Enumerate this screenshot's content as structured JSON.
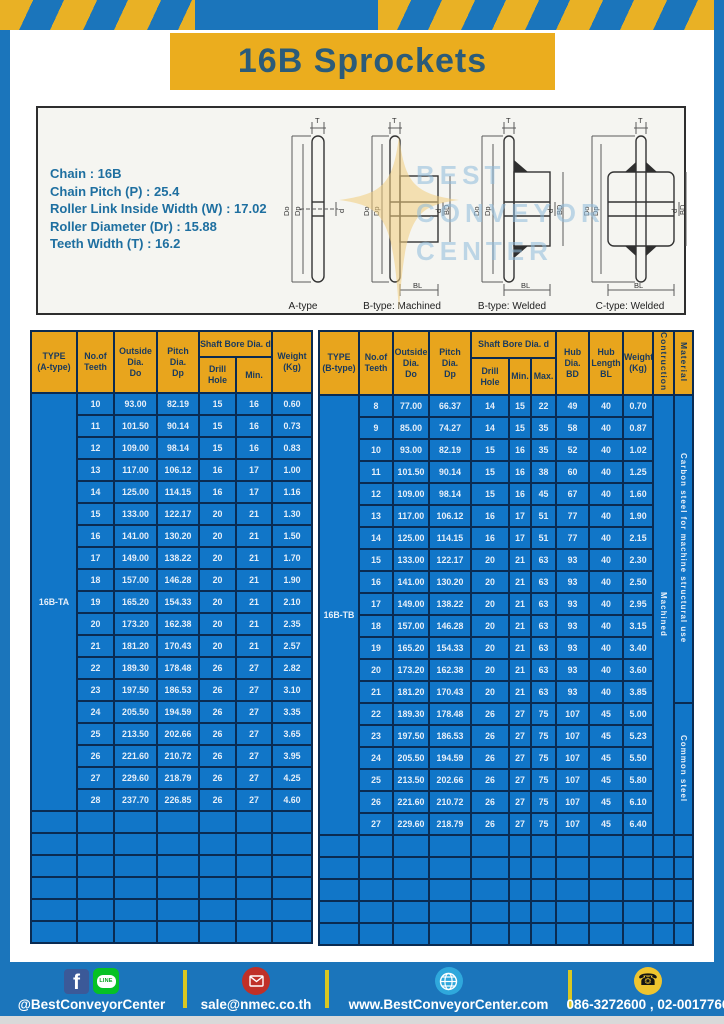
{
  "page": {
    "title": "16B Sprockets"
  },
  "specs": {
    "lines": [
      "Chain  :  16B",
      "Chain Pitch (P)  :  25.4",
      "Roller Link Inside Width (W)  :  17.02",
      "Roller Diameter (Dr)  : 15.88",
      "Teeth Width (T)  :  16.2"
    ]
  },
  "watermark": {
    "lines": [
      "BEST",
      "CONVEYOR",
      "CENTER"
    ]
  },
  "drawings": {
    "captions": [
      "A-type",
      "B-type: Machined",
      "B-type: Welded",
      "C-type: Welded"
    ],
    "dims": {
      "t": "T",
      "do": "Do",
      "dp": "Dp",
      "d": "d",
      "bd": "BD",
      "bl": "BL"
    }
  },
  "tables": {
    "a": {
      "type_label": "16B-TA",
      "headers": {
        "type": "TYPE\n(A-type)",
        "teeth": "No.of\nTeeth",
        "outside": "Outside\nDia.\nDo",
        "pitch": "Pitch Dia.\nDp",
        "shaft_bore": "Shaft Bore Dia. d",
        "drill": "Drill Hole",
        "min": "Min.",
        "weight": "Weight\n(Kg)"
      },
      "rows": [
        [
          "10",
          "93.00",
          "82.19",
          "15",
          "16",
          "0.60"
        ],
        [
          "11",
          "101.50",
          "90.14",
          "15",
          "16",
          "0.73"
        ],
        [
          "12",
          "109.00",
          "98.14",
          "15",
          "16",
          "0.83"
        ],
        [
          "13",
          "117.00",
          "106.12",
          "16",
          "17",
          "1.00"
        ],
        [
          "14",
          "125.00",
          "114.15",
          "16",
          "17",
          "1.16"
        ],
        [
          "15",
          "133.00",
          "122.17",
          "20",
          "21",
          "1.30"
        ],
        [
          "16",
          "141.00",
          "130.20",
          "20",
          "21",
          "1.50"
        ],
        [
          "17",
          "149.00",
          "138.22",
          "20",
          "21",
          "1.70"
        ],
        [
          "18",
          "157.00",
          "146.28",
          "20",
          "21",
          "1.90"
        ],
        [
          "19",
          "165.20",
          "154.33",
          "20",
          "21",
          "2.10"
        ],
        [
          "20",
          "173.20",
          "162.38",
          "20",
          "21",
          "2.35"
        ],
        [
          "21",
          "181.20",
          "170.43",
          "20",
          "21",
          "2.57"
        ],
        [
          "22",
          "189.30",
          "178.48",
          "26",
          "27",
          "2.82"
        ],
        [
          "23",
          "197.50",
          "186.53",
          "26",
          "27",
          "3.10"
        ],
        [
          "24",
          "205.50",
          "194.59",
          "26",
          "27",
          "3.35"
        ],
        [
          "25",
          "213.50",
          "202.66",
          "26",
          "27",
          "3.65"
        ],
        [
          "26",
          "221.60",
          "210.72",
          "26",
          "27",
          "3.95"
        ],
        [
          "27",
          "229.60",
          "218.79",
          "26",
          "27",
          "4.25"
        ],
        [
          "28",
          "237.70",
          "226.85",
          "26",
          "27",
          "4.60"
        ]
      ],
      "empty_row_count": 6
    },
    "b": {
      "type_label": "16B-TB",
      "headers": {
        "type": "TYPE\n(B-type)",
        "teeth": "No.of\nTeeth",
        "outside": "Outside\nDia.\nDo",
        "pitch": "Pitch Dia.\nDp",
        "shaft_bore": "Shaft Bore Dia. d",
        "drill": "Drill Hole",
        "min": "Min.",
        "max": "Max.",
        "hub_dia": "Hub Dia.\nBD",
        "hub_len": "Hub\nLength\nBL",
        "weight": "Weight\n(Kg)",
        "construction": "Contruction",
        "material": "Material"
      },
      "rows": [
        [
          "8",
          "77.00",
          "66.37",
          "14",
          "15",
          "22",
          "49",
          "40",
          "0.70"
        ],
        [
          "9",
          "85.00",
          "74.27",
          "14",
          "15",
          "35",
          "58",
          "40",
          "0.87"
        ],
        [
          "10",
          "93.00",
          "82.19",
          "15",
          "16",
          "35",
          "52",
          "40",
          "1.02"
        ],
        [
          "11",
          "101.50",
          "90.14",
          "15",
          "16",
          "38",
          "60",
          "40",
          "1.25"
        ],
        [
          "12",
          "109.00",
          "98.14",
          "15",
          "16",
          "45",
          "67",
          "40",
          "1.60"
        ],
        [
          "13",
          "117.00",
          "106.12",
          "16",
          "17",
          "51",
          "77",
          "40",
          "1.90"
        ],
        [
          "14",
          "125.00",
          "114.15",
          "16",
          "17",
          "51",
          "77",
          "40",
          "2.15"
        ],
        [
          "15",
          "133.00",
          "122.17",
          "20",
          "21",
          "63",
          "93",
          "40",
          "2.30"
        ],
        [
          "16",
          "141.00",
          "130.20",
          "20",
          "21",
          "63",
          "93",
          "40",
          "2.50"
        ],
        [
          "17",
          "149.00",
          "138.22",
          "20",
          "21",
          "63",
          "93",
          "40",
          "2.95"
        ],
        [
          "18",
          "157.00",
          "146.28",
          "20",
          "21",
          "63",
          "93",
          "40",
          "3.15"
        ],
        [
          "19",
          "165.20",
          "154.33",
          "20",
          "21",
          "63",
          "93",
          "40",
          "3.40"
        ],
        [
          "20",
          "173.20",
          "162.38",
          "20",
          "21",
          "63",
          "93",
          "40",
          "3.60"
        ],
        [
          "21",
          "181.20",
          "170.43",
          "20",
          "21",
          "63",
          "93",
          "40",
          "3.85"
        ],
        [
          "22",
          "189.30",
          "178.48",
          "26",
          "27",
          "75",
          "107",
          "45",
          "5.00"
        ],
        [
          "23",
          "197.50",
          "186.53",
          "26",
          "27",
          "75",
          "107",
          "45",
          "5.23"
        ],
        [
          "24",
          "205.50",
          "194.59",
          "26",
          "27",
          "75",
          "107",
          "45",
          "5.50"
        ],
        [
          "25",
          "213.50",
          "202.66",
          "26",
          "27",
          "75",
          "107",
          "45",
          "5.80"
        ],
        [
          "26",
          "221.60",
          "210.72",
          "26",
          "27",
          "75",
          "107",
          "45",
          "6.10"
        ],
        [
          "27",
          "229.60",
          "218.79",
          "26",
          "27",
          "75",
          "107",
          "45",
          "6.40"
        ]
      ],
      "construction": "Machined",
      "material_groups": [
        {
          "label": "Carbon steel for machine structural use",
          "rows": 14
        },
        {
          "label": "Common steel",
          "rows": 6
        }
      ],
      "empty_row_count": 5
    }
  },
  "footer": {
    "line_icon_text": "LINE",
    "items": [
      {
        "text": "@BestConveyorCenter"
      },
      {
        "text": "sale@nmec.co.th"
      },
      {
        "text": "www.BestConveyorCenter.com"
      },
      {
        "text": "086-3272600 , 02-0017766"
      }
    ]
  }
}
